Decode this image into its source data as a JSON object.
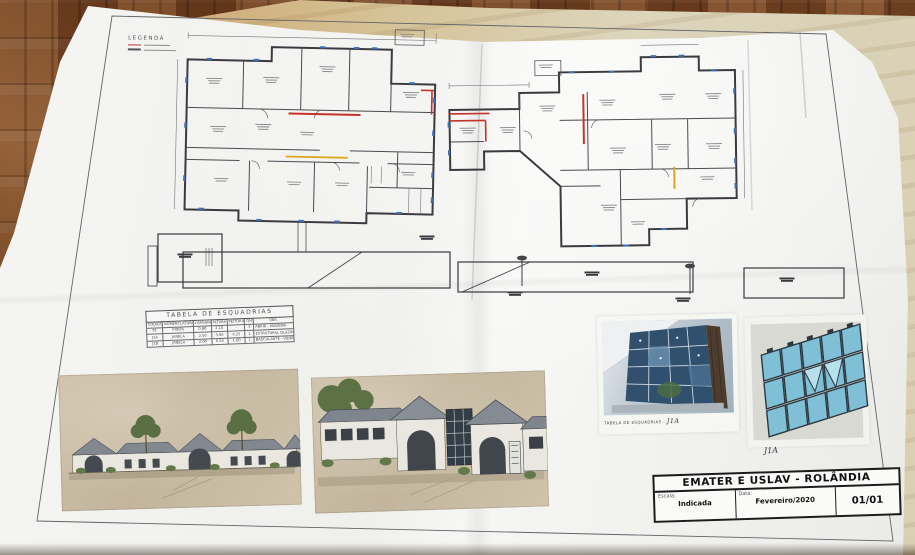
{
  "legend": {
    "title": "LEGENDA"
  },
  "esquadrias_table": {
    "title": "TABELA DE ESQUADRIAS",
    "headers": [
      "CÓDIGO",
      "NOMENCLATURA",
      "LARGURA",
      "ALTURA",
      "PEITORIL",
      "QNT.",
      "OBS."
    ],
    "rows": [
      [
        "P1",
        "PORTA",
        "0.80",
        "2.10",
        "-",
        "3",
        "ABRIR - MADEIRA"
      ],
      [
        "J1A",
        "JANELA",
        "2.50",
        "3.00",
        "0.25",
        "1",
        "ESTRUTURAL GLAZING"
      ],
      [
        "J1B",
        "JANELA",
        "2.00",
        "0.50",
        "1.60",
        "1",
        "BASCULANTE - VIDRO"
      ]
    ]
  },
  "glass_photo": {
    "caption_label": "TABELA DE ESQUADRIAS -",
    "caption_code": "J1A"
  },
  "glass_render": {
    "caption_code": "J1A"
  },
  "title_block": {
    "title": "EMATER E USLAV - ROLÂNDIA",
    "scale_label": "Escala:",
    "scale_value": "Indicada",
    "date_label": "Data:",
    "date_value": "Fevereiro/2020",
    "sheet_number": "01/01"
  },
  "colors": {
    "plan_red": "#c5332b",
    "plan_yellow": "#dca61f",
    "plan_blue": "#3f72b8",
    "ink": "#3a3a40",
    "wood_floor": "#6d3f22",
    "kraft_paper": "#c89a62",
    "sheet_paper": "#f2f2f0",
    "glass_blue": "#7fc0d6"
  }
}
